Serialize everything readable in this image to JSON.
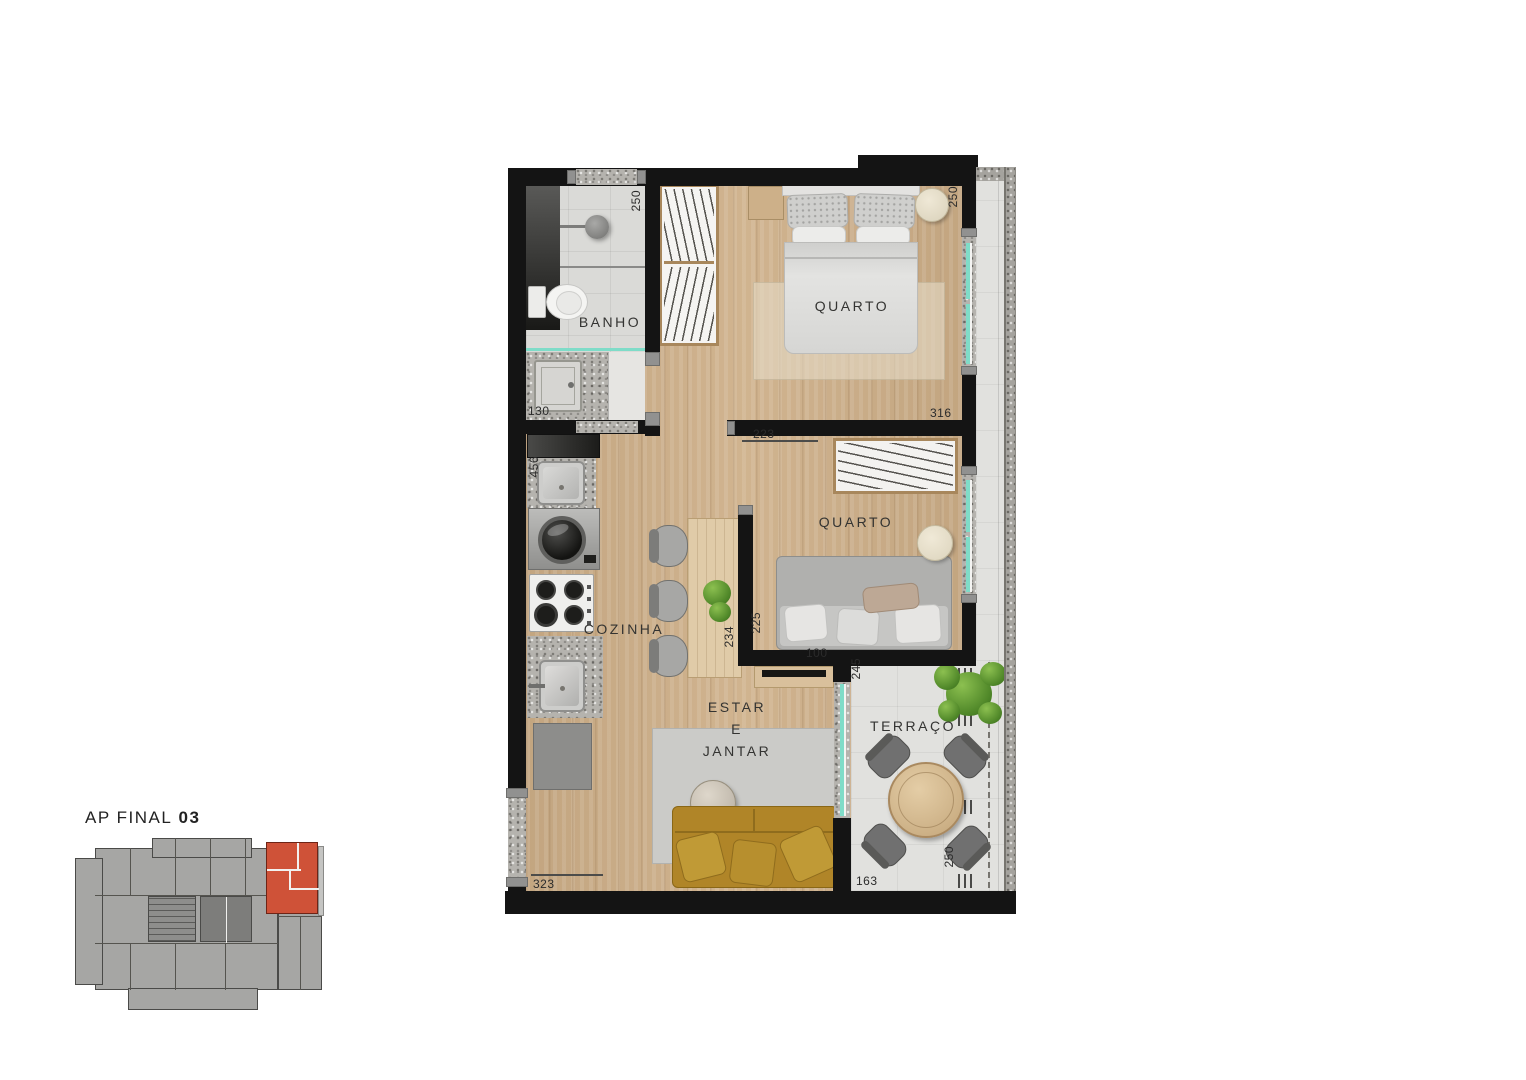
{
  "title": {
    "prefix": "AP FINAL",
    "number": "03"
  },
  "rooms": {
    "bathroom": "BANHO",
    "bedroom1": "QUARTO",
    "bedroom2": "QUARTO",
    "kitchen": "COZINHA",
    "living_line1": "ESTAR",
    "living_line2": "E",
    "living_line3": "JANTAR",
    "terrace": "TERRAÇO"
  },
  "dimensions": {
    "bath_top": "250",
    "bed1_top_right": "250",
    "bath_bottom": "130",
    "bed1_bottom_right": "316",
    "bed1_wall": "223",
    "kitchen_sink": "456",
    "dining_side": "234",
    "bed2_side": "225",
    "bed2_bottom": "100",
    "terrace_top": "245",
    "living_bottom_right": "250",
    "living_bottom_left": "323",
    "terrace_bottom_left": "163"
  },
  "colors": {
    "wall": "#141414",
    "wood_floor": "#cdae87",
    "tile_floor": "#dadad7",
    "terrace_floor": "#e1e1de",
    "granite": "#b5b3ae",
    "window_glass": "#7fdcc8",
    "sofa": "#b08528",
    "unit_highlight": "#cf5238",
    "keyplan_gray": "#a6a6a4"
  }
}
